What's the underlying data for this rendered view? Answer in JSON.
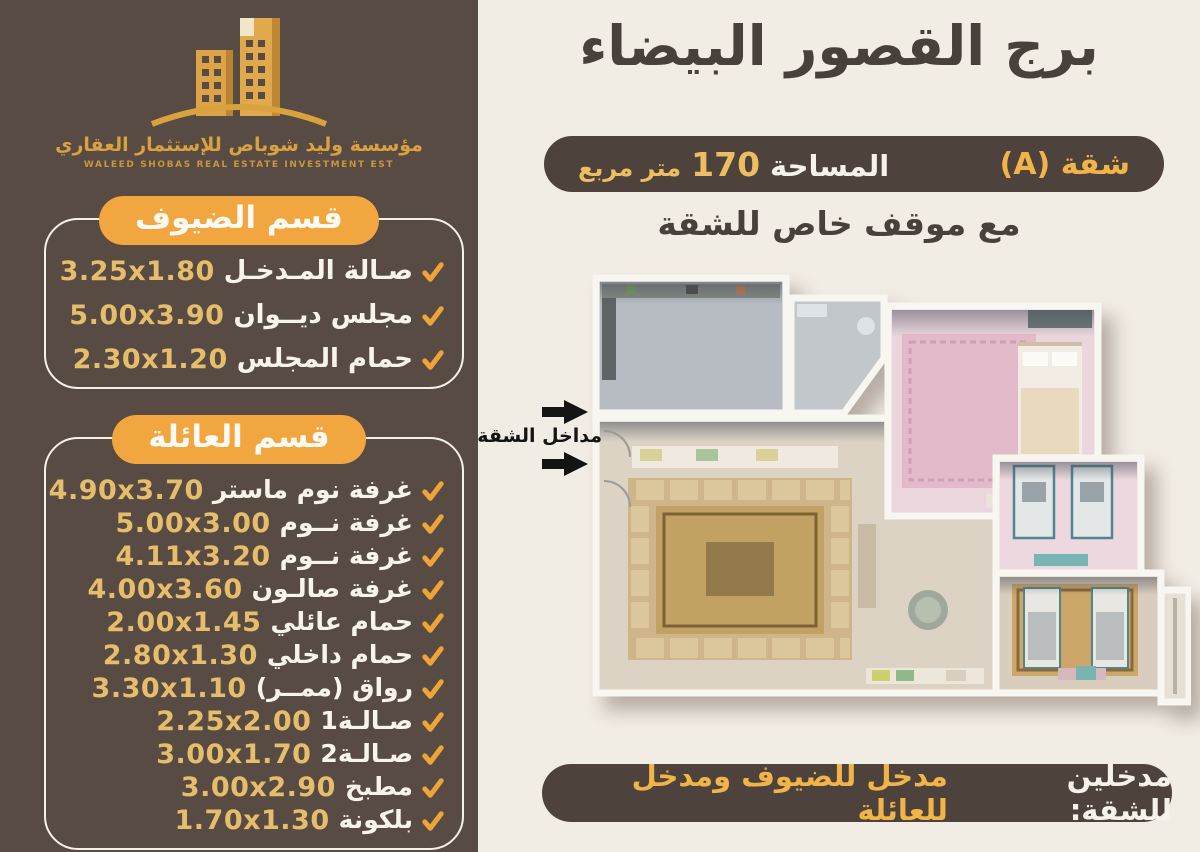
{
  "colors": {
    "panel_brown": "#574b44",
    "cream_bg": "#f1ece4",
    "badge_orange": "#f2a640",
    "gold_text": "#e6bd6a",
    "pill_dark": "#4e423d",
    "pill_gold": "#f0b449",
    "check_gold": "#eea436"
  },
  "logo": {
    "arabic": "مؤسسة وليد شوباص للإستثمار العقاري",
    "english": "WALEED SHOBAS REAL ESTATE INVESTMENT EST"
  },
  "sections": [
    {
      "title": "قسم الضيوف",
      "items": [
        {
          "name": "صـالة المـدخـل",
          "dims": "3.25x1.80"
        },
        {
          "name": "مجلس ديــوان",
          "dims": "5.00x3.90"
        },
        {
          "name": "حمام المجلس",
          "dims": "2.30x1.20"
        }
      ]
    },
    {
      "title": "قسم العائلة",
      "items": [
        {
          "name": "غرفة نوم ماستر",
          "dims": "4.90x3.70"
        },
        {
          "name": "غرفة نــوم",
          "dims": "5.00x3.00"
        },
        {
          "name": "غرفة نــوم",
          "dims": "4.11x3.20"
        },
        {
          "name": "غرفة صالـون",
          "dims": "4.00x3.60"
        },
        {
          "name": "حمام عائلي",
          "dims": "2.00x1.45"
        },
        {
          "name": "حمام داخلي",
          "dims": "2.80x1.30"
        },
        {
          "name": "رواق (ممــر)",
          "dims": "3.30x1.10"
        },
        {
          "name": "صـالـة1",
          "dims": "2.25x2.00"
        },
        {
          "name": "صـالـة2",
          "dims": "3.00x1.70"
        },
        {
          "name": "مطبخ",
          "dims": "3.00x2.90"
        },
        {
          "name": "بلكونة",
          "dims": "1.70x1.30"
        }
      ]
    }
  ],
  "header": {
    "title": "برج القصور البيضاء",
    "apartment": "شقة (A)",
    "area_label": "المساحة",
    "area_value": "170",
    "area_unit": "متر مربع",
    "parking_note": "مع موقف خاص للشقة"
  },
  "plan": {
    "entrances_label": "مداخل الشقة"
  },
  "footer": {
    "prefix": "مدخلين للشقة:",
    "text": "مدخل للضيوف ومدخل للعائلة"
  }
}
